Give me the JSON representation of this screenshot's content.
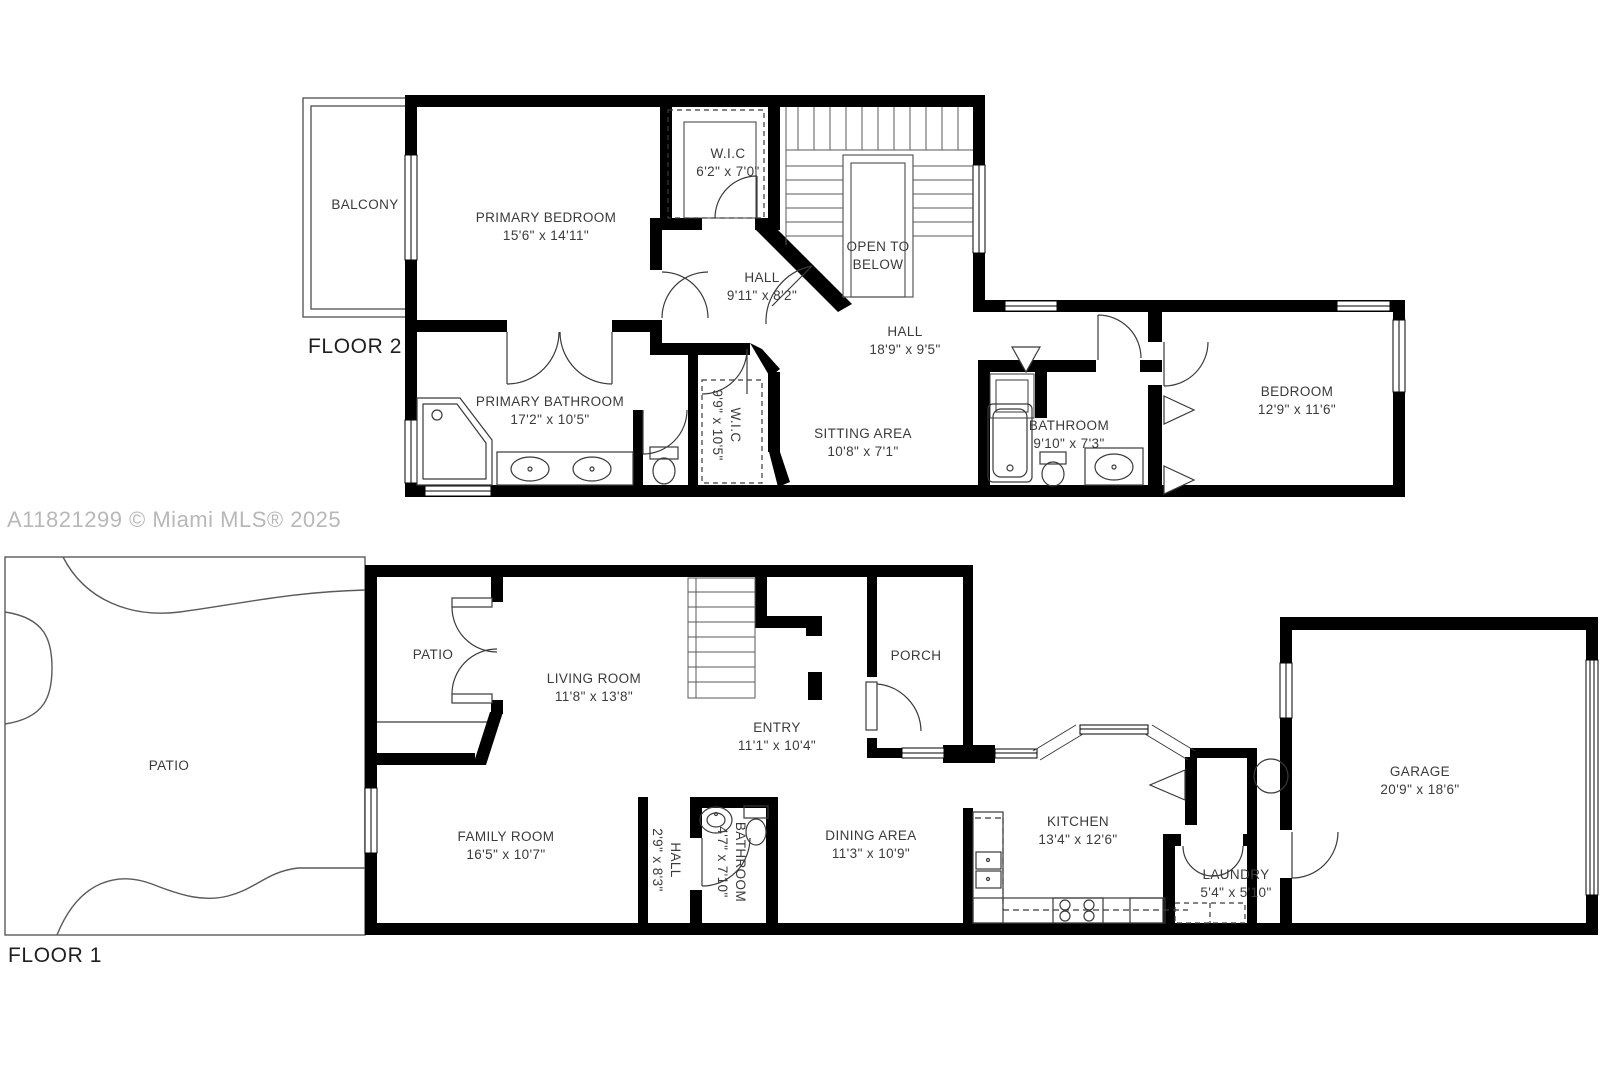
{
  "watermark": "A11821299 © Miami MLS® 2025",
  "floor2": {
    "title": "FLOOR 2",
    "rooms": [
      {
        "name": "BALCONY",
        "dims": ""
      },
      {
        "name": "PRIMARY BEDROOM",
        "dims": "15'6\" x 14'11\""
      },
      {
        "name": "W.I.C",
        "dims": "6'2\" x 7'0\""
      },
      {
        "name": "OPEN TO BELOW",
        "dims": ""
      },
      {
        "name": "HALL",
        "dims": "9'11\" x 8'2\""
      },
      {
        "name": "HALL",
        "dims": "18'9\" x 9'5\""
      },
      {
        "name": "PRIMARY BATHROOM",
        "dims": "17'2\" x 10'5\""
      },
      {
        "name": "W.I.C",
        "dims": "9'9\" x 10'5\""
      },
      {
        "name": "SITTING AREA",
        "dims": "10'8\" x 7'1\""
      },
      {
        "name": "BATHROOM",
        "dims": "9'10\" x 7'3\""
      },
      {
        "name": "BEDROOM",
        "dims": "12'9\" x 11'6\""
      }
    ]
  },
  "floor1": {
    "title": "FLOOR 1",
    "rooms": [
      {
        "name": "PATIO",
        "dims": ""
      },
      {
        "name": "PATIO",
        "dims": ""
      },
      {
        "name": "LIVING ROOM",
        "dims": "11'8\" x 13'8\""
      },
      {
        "name": "ENTRY",
        "dims": "11'1\" x 10'4\""
      },
      {
        "name": "PORCH",
        "dims": ""
      },
      {
        "name": "FAMILY ROOM",
        "dims": "16'5\" x 10'7\""
      },
      {
        "name": "HALL",
        "dims": "2'9\" x 8'3\""
      },
      {
        "name": "BATHROOM",
        "dims": "4'7\" x 7'10\""
      },
      {
        "name": "DINING AREA",
        "dims": "11'3\" x 10'9\""
      },
      {
        "name": "KITCHEN",
        "dims": "13'4\" x 12'6\""
      },
      {
        "name": "LAUNDRY",
        "dims": "5'4\" x 5'10\""
      },
      {
        "name": "GARAGE",
        "dims": "20'9\" x 18'6\""
      }
    ]
  },
  "colors": {
    "wall": "#000000",
    "thin_line": "#3a3a3a",
    "text": "#3b3b3b",
    "watermark": "#b8b8b8",
    "background": "#ffffff"
  }
}
